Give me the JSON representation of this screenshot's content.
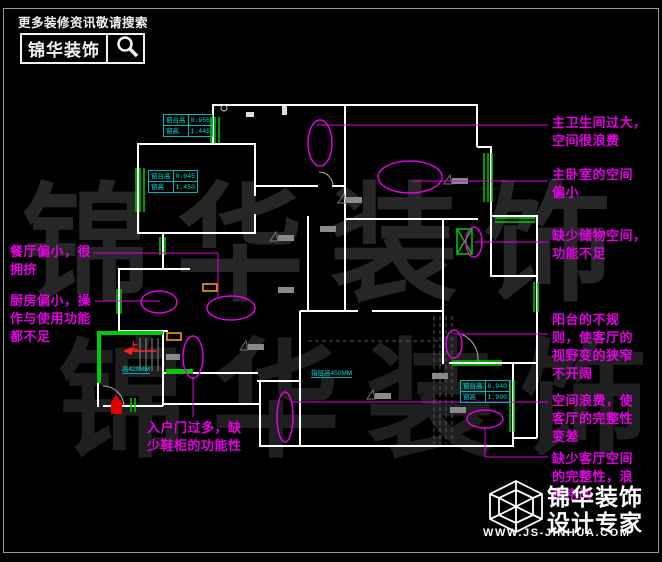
{
  "header": {
    "tagline": "更多装修资讯敬请搜索",
    "brand": "锦华装饰"
  },
  "watermark": {
    "row1": "锦华装饰",
    "row2": "锦华装饰"
  },
  "plan": {
    "window_tables": [
      {
        "rows": [
          [
            "窗台高",
            "0.955"
          ],
          [
            "窗高",
            "1.445"
          ]
        ]
      },
      {
        "rows": [
          [
            "窗台高",
            "0.945"
          ],
          [
            "窗高",
            "1.450"
          ]
        ]
      },
      {
        "rows": [
          [
            "窗台高",
            "0.940"
          ],
          [
            "窗高",
            "1.900"
          ]
        ]
      }
    ],
    "labels": {
      "step_height": "高420MM",
      "split_level": "错层高450MM",
      "stairs_up": "上"
    }
  },
  "annotations": {
    "right": [
      {
        "lines": [
          "主卫生间过大，",
          "空间很浪费"
        ]
      },
      {
        "lines": [
          "主卧室的空间",
          "偏小"
        ]
      },
      {
        "lines": [
          "缺少储物空间，",
          "功能不足"
        ]
      },
      {
        "lines": [
          "阳台的不规",
          "则，使客厅的",
          "视野变的狭窄",
          "不开阔"
        ]
      },
      {
        "lines": [
          "空间浪费，使",
          "客厅的完整性",
          "变差"
        ]
      },
      {
        "lines": [
          "缺少客厅空间",
          "的完整性，浪",
          "费空间"
        ]
      }
    ],
    "left": [
      {
        "lines": [
          "餐厅偏小，很",
          "拥挤"
        ]
      },
      {
        "lines": [
          "厨房偏小，操",
          "作与使用功能",
          "都不足"
        ]
      }
    ],
    "bottom": [
      {
        "lines": [
          "入户门过多，缺",
          "少鞋柜的功能性"
        ]
      }
    ]
  },
  "footer": {
    "brand": "锦华装饰",
    "subtitle": "设计专家",
    "url": "WWW.JS-JINHUA.COM"
  },
  "colors": {
    "annotation_magenta": "#e400e4",
    "wall_white": "#ffffff",
    "window_green": "#00cc00",
    "dim_cyan": "#00dddd",
    "appliance_orange": "#ffaa00",
    "alert_red": "#ff1111"
  }
}
